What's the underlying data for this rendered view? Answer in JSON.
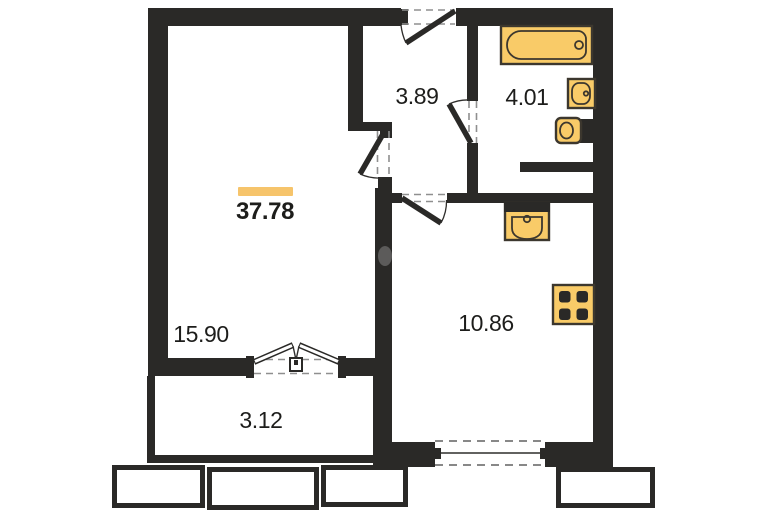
{
  "total": {
    "area": "37.78"
  },
  "rooms": {
    "living": {
      "area": "15.90"
    },
    "hall": {
      "area": "3.89"
    },
    "bath": {
      "area": "4.01"
    },
    "kitchen": {
      "area": "10.86"
    },
    "balcony": {
      "area": "3.12"
    }
  },
  "fixtures": [
    "bathtub-icon",
    "washbasin-icon",
    "toilet-icon",
    "kitchen-sink-icon",
    "stove-icon"
  ],
  "colors": {
    "wall": "#2a2927",
    "fixture_fill": "#f9cb68",
    "fixture_stroke": "#3c372e",
    "accent_bar": "#f6c46b",
    "dash": "#8f8f8f",
    "window_dash": "#787878",
    "text": "#1d1d1b",
    "bg": "#ffffff"
  }
}
